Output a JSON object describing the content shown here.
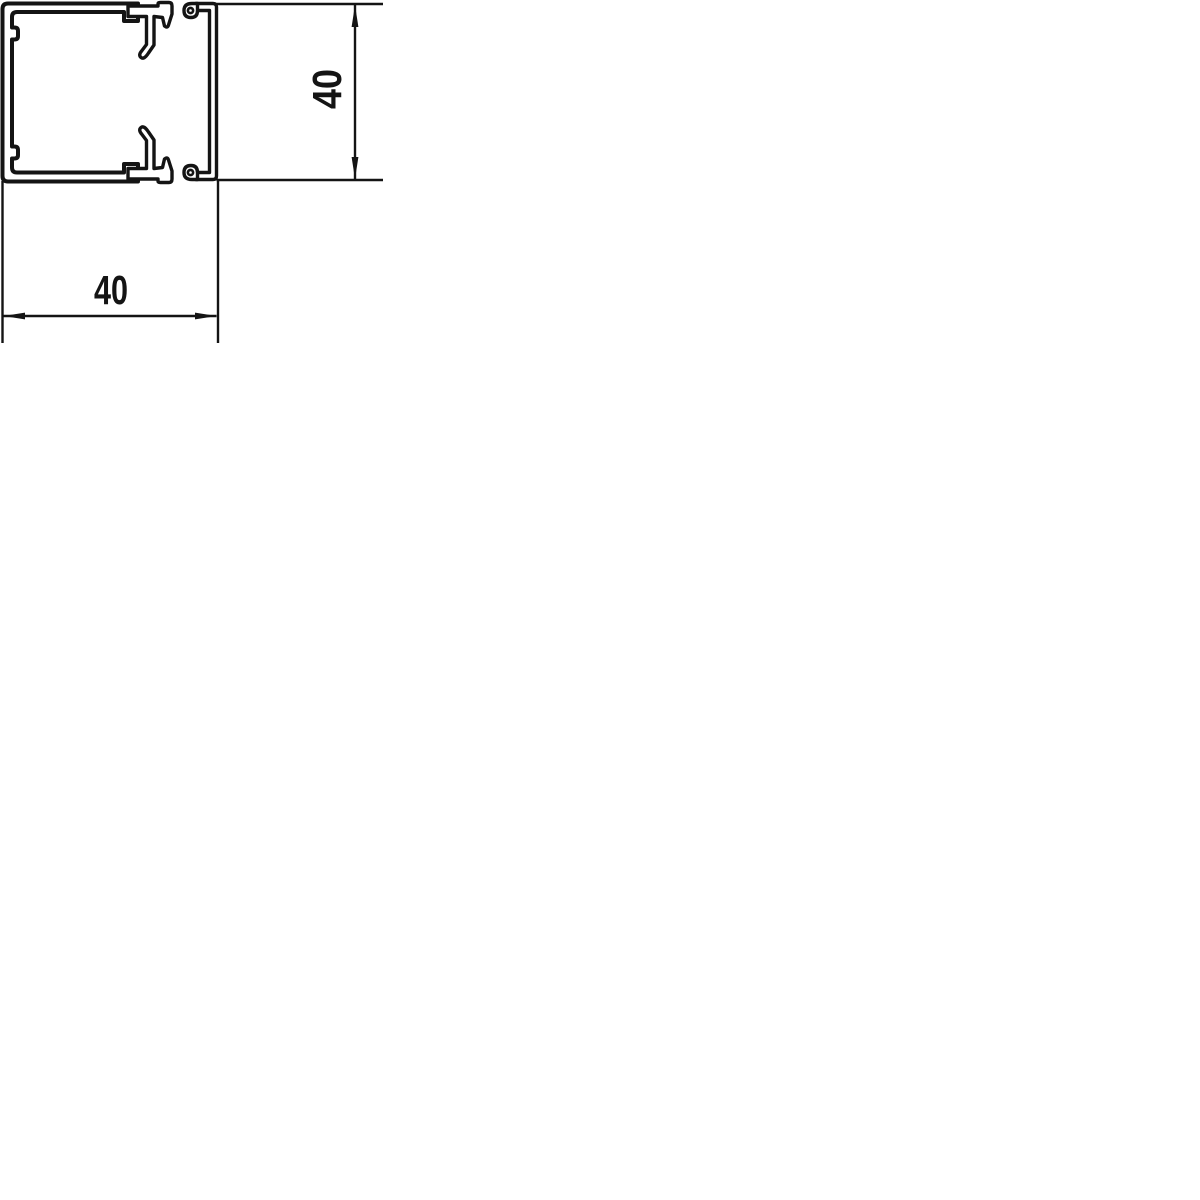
{
  "page": {
    "background_color": "#ffffff"
  },
  "drawing": {
    "kind": "technical cross-section drawing",
    "subject": "square cable trunking profile: base part with two snap-in clip rails and separate slide-on cover",
    "line_color": "#141414",
    "dimensions": {
      "width": {
        "label": "40"
      },
      "height": {
        "label": "40"
      }
    }
  }
}
